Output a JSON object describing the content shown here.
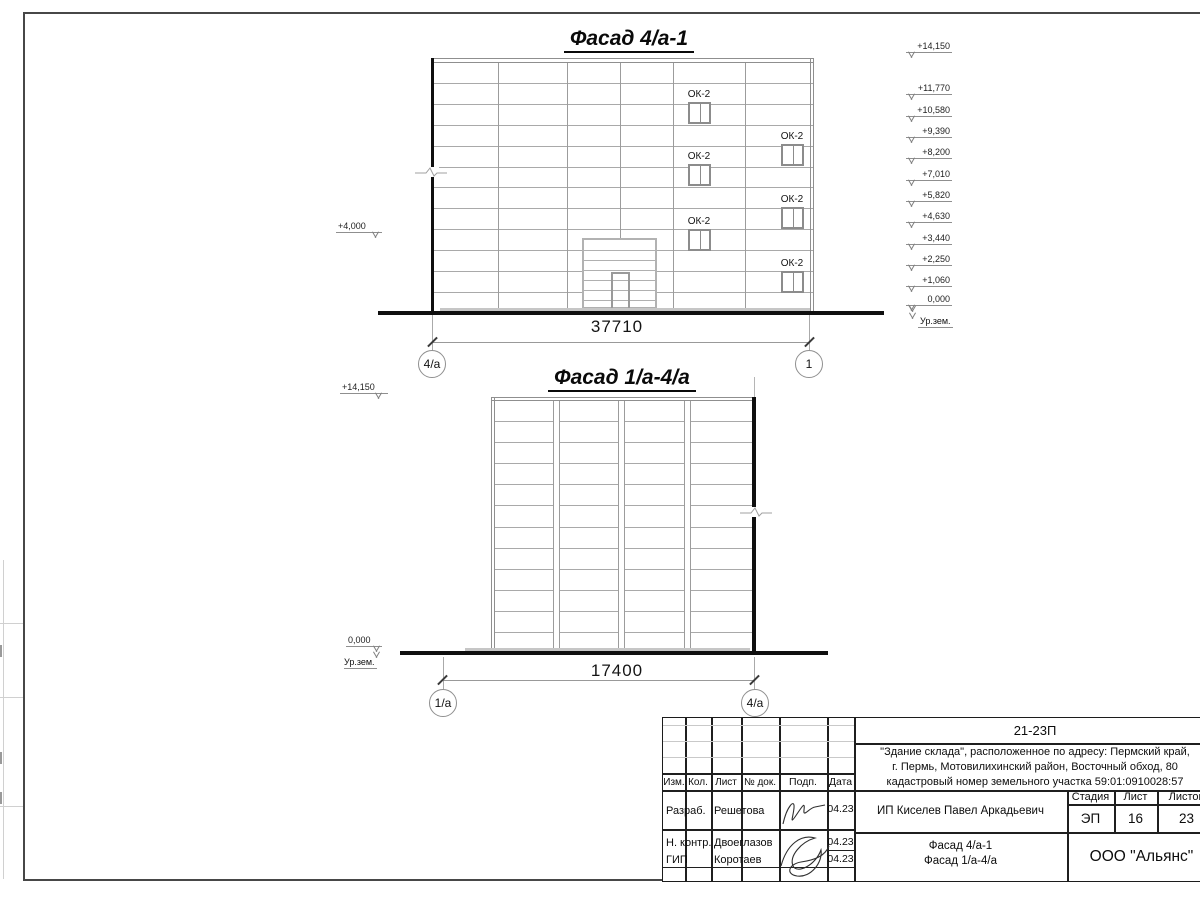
{
  "facade1": {
    "title": "Фасад 4/а-1",
    "dimension": "37710",
    "axis_left": "4/а",
    "axis_right": "1",
    "window_label": "ОК-2",
    "left_elevation": "+4,000",
    "ground_label": "Ур.зем.",
    "elevations": [
      "+14,150",
      "+11,770",
      "+10,580",
      "+9,390",
      "+8,200",
      "+7,010",
      "+5,820",
      "+4,630",
      "+3,440",
      "+2,250",
      "+1,060",
      "0,000"
    ]
  },
  "facade2": {
    "title": "Фасад 1/а-4/а",
    "dimension": "17400",
    "axis_left": "1/а",
    "axis_right": "4/а",
    "elevation_top": "+14,150",
    "elevation_zero": "0,000",
    "ground_label": "Ур.зем."
  },
  "title_block": {
    "project_code": "21-23П",
    "description_line1": "\"Здание склада\", расположенное по адресу: Пермский край,",
    "description_line2": "г. Пермь, Мотовилихинский район, Восточный обход, 80",
    "description_line3": "кадастровый номер земельного участка 59:01:0910028:57",
    "columns": {
      "izm": "Изм.",
      "kol": "Кол.",
      "list": "Лист",
      "doc": "№ док.",
      "podp": "Подп.",
      "data": "Дата"
    },
    "rows": [
      {
        "role": "Разраб.",
        "name": "Решетова",
        "date": "04.23"
      },
      {
        "role": "Н. контр.",
        "name": "Двоеглазов",
        "date": "04.23"
      },
      {
        "role": "ГИП",
        "name": "Коротаев",
        "date": "04.23"
      }
    ],
    "client": "ИП Киселев Павел Аркадьевич",
    "stage_label": "Стадия",
    "sheet_label": "Лист",
    "sheets_label": "Листов",
    "stage": "ЭП",
    "sheet_number": "16",
    "sheets_total": "23",
    "drawing_title_line1": "Фасад 4/а-1",
    "drawing_title_line2": "Фасад 1/а-4/а",
    "company": "ООО \"Альянс\""
  }
}
